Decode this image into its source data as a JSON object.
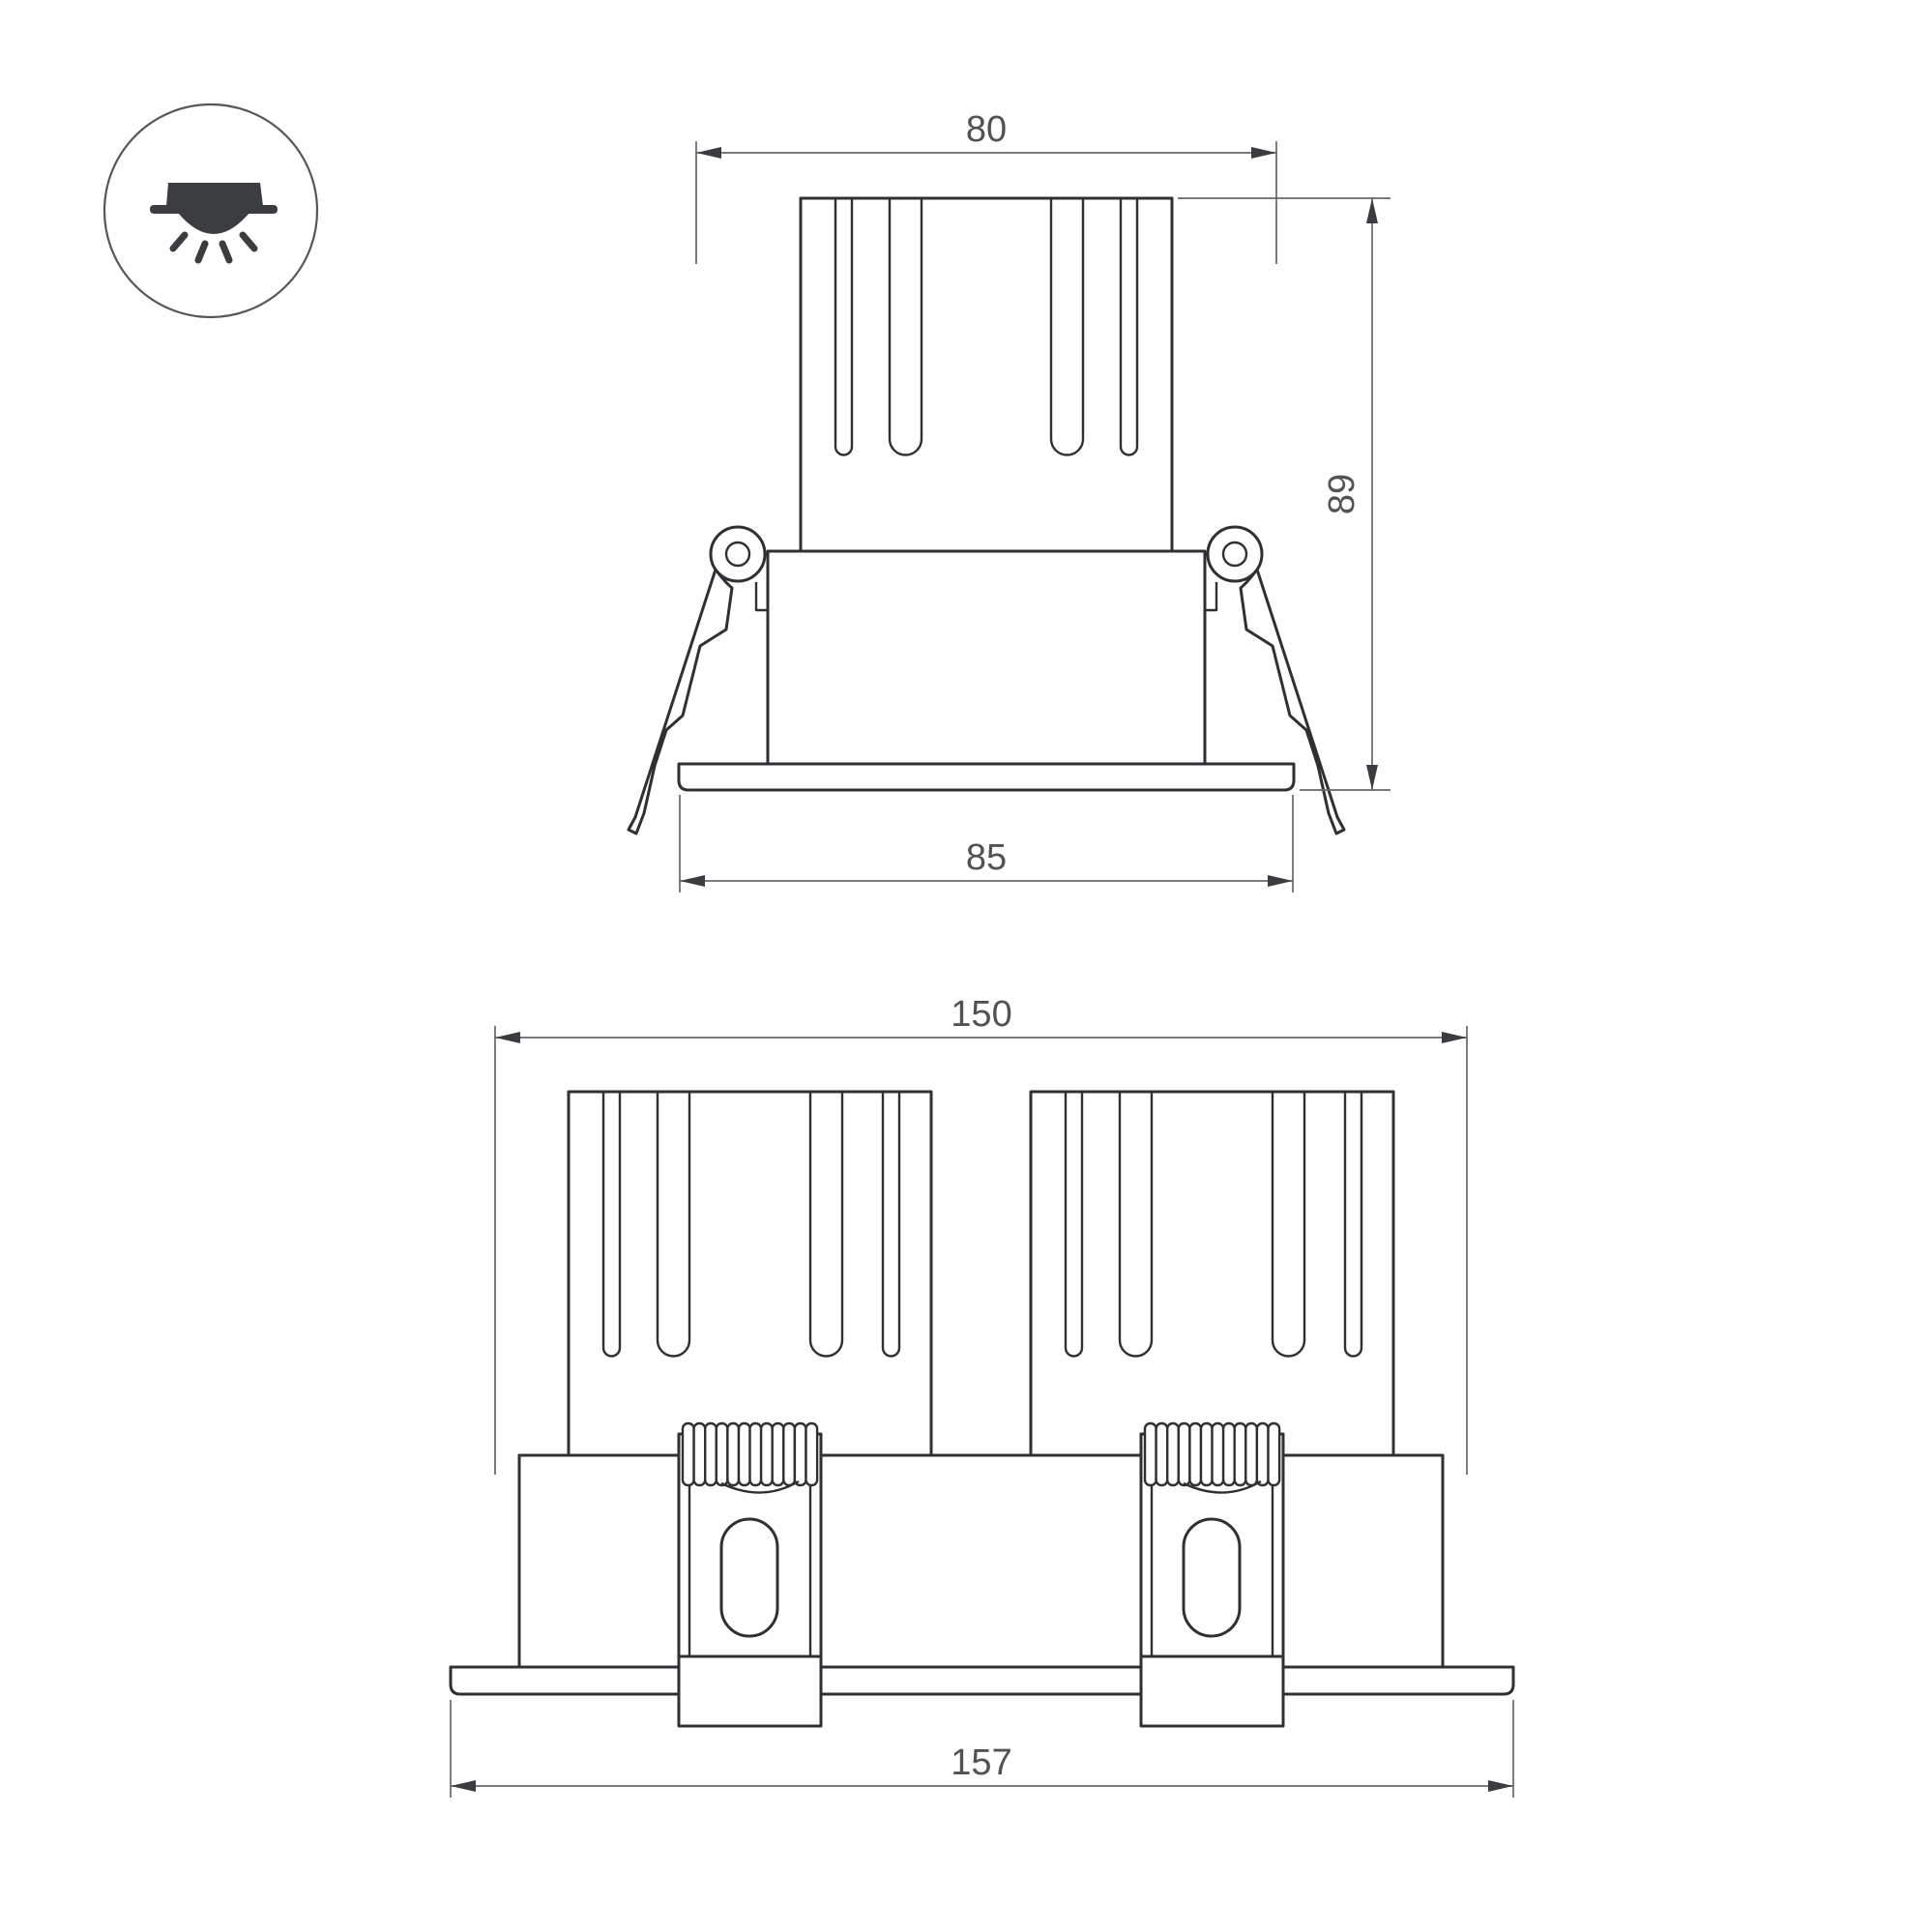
{
  "icon": {
    "name": "recessed-downlight"
  },
  "single_view": {
    "top_width_label": "80",
    "height_label": "89",
    "flange_width_label": "85"
  },
  "double_view": {
    "width_label": "150",
    "flange_width_label": "157"
  },
  "colors": {
    "background": "#ffffff",
    "outline": "#2f3033",
    "dimension": "#67686b",
    "arrow": "#3b3c3f",
    "text": "#515254",
    "icon": "#3c3d40",
    "icon_ring": "#55565a"
  }
}
